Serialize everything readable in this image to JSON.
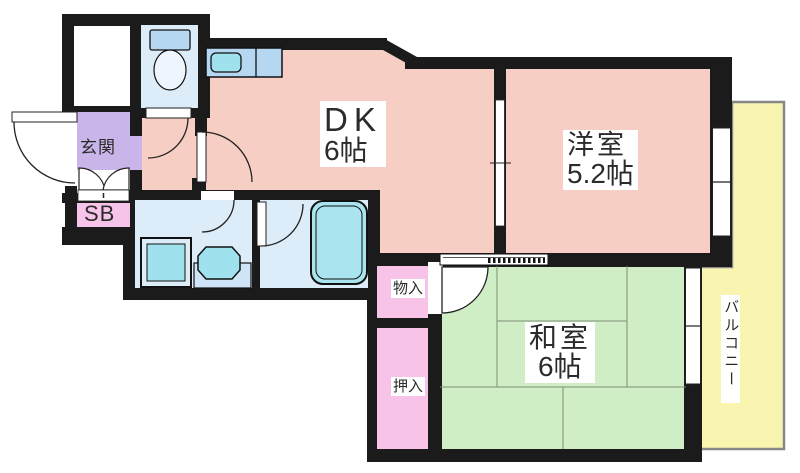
{
  "rooms": {
    "dk": {
      "name": "DK",
      "size": "6帖"
    },
    "western": {
      "name": "洋室",
      "size": "5.2帖"
    },
    "japanese": {
      "name": "和室",
      "size": "6帖"
    }
  },
  "areas": {
    "entrance": "玄関",
    "shoe_box": "SB",
    "storage": "物入",
    "closet": "押入",
    "balcony": "バルコニー"
  },
  "colors": {
    "wall": "#1b1b1b",
    "room_pink": "#f6cec3",
    "tatami_green": "#cfeec6",
    "balcony_yellow": "#f9f5b0",
    "entrance_purple": "#c9b5e9",
    "closet_pink": "#f7c3e8",
    "water_blue": "#dcecf8",
    "counter_blue": "#b5d7f2",
    "fixture_cyan": "#9fe2ee",
    "tank_blue": "#b5d7f2",
    "tub_cyan": "#a9e4ef"
  }
}
